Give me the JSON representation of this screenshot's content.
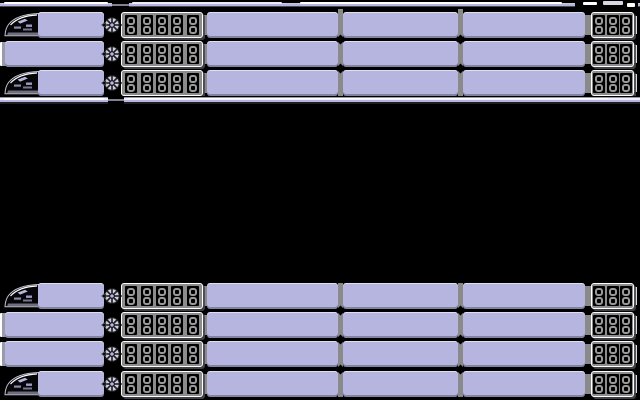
{
  "scene": {
    "background": "#000000",
    "palette": {
      "hull_lavender": "#b5b5df",
      "panel_gray": "#8c8c8c",
      "digit_gray": "#999999",
      "pillar_gray": "#8a8a8a",
      "highlight_white": "#ffffff",
      "shadow_dark": "#4a4a56"
    }
  },
  "display": {
    "left_digits": "88888",
    "right_digits": "888"
  },
  "groups": [
    {
      "name": "upper-train-group",
      "rows": [
        {
          "type": "nose",
          "y": 12
        },
        {
          "type": "flat",
          "y": 41
        },
        {
          "type": "nose",
          "y": 70
        }
      ],
      "pillars": {
        "x": [
          338,
          458
        ],
        "top": 9,
        "bottom": 97
      },
      "has_rails": true
    },
    {
      "name": "lower-train-group",
      "rows": [
        {
          "type": "nose",
          "y": 283
        },
        {
          "type": "flat",
          "y": 312
        },
        {
          "type": "flat",
          "y": 341
        },
        {
          "type": "nose",
          "y": 371
        }
      ],
      "pillars": {
        "x": [
          338,
          458
        ],
        "top": 283,
        "bottom": 397
      },
      "has_rails": false
    }
  ],
  "rails": {
    "top_y": 1,
    "bottom_y": 96
  }
}
